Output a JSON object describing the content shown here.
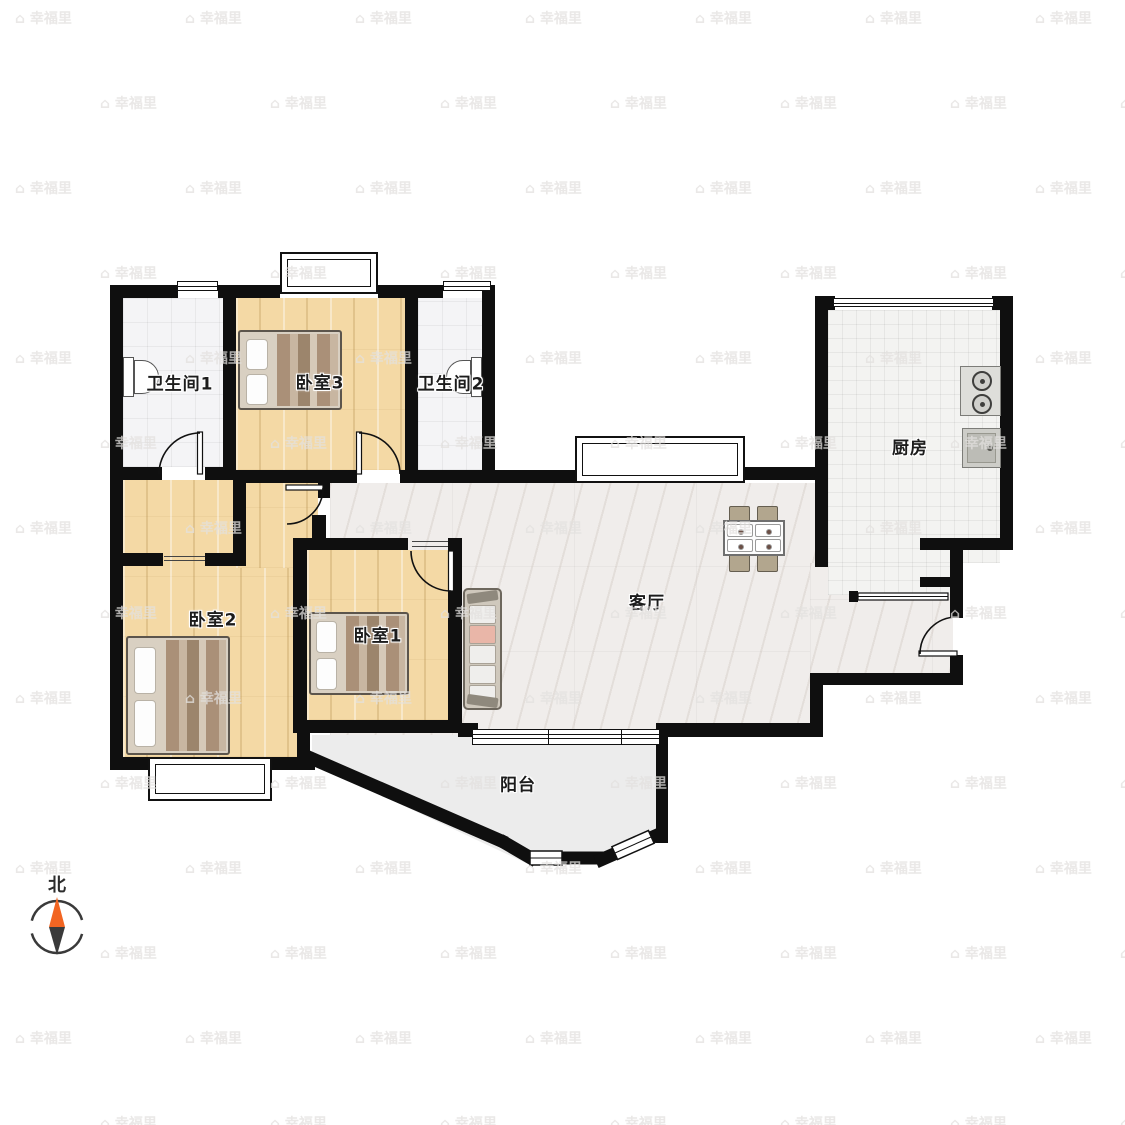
{
  "plan": {
    "type": "apartment-floor-plan",
    "rooms": {
      "bathroom1": {
        "label": "卫生间1"
      },
      "bedroom3": {
        "label": "卧室3"
      },
      "bathroom2": {
        "label": "卫生间2"
      },
      "kitchen": {
        "label": "厨房"
      },
      "bedroom2": {
        "label": "卧室2"
      },
      "bedroom1": {
        "label": "卧室1"
      },
      "living_room": {
        "label": "客厅"
      },
      "balcony": {
        "label": "阳台"
      }
    },
    "furniture_icons": [
      "bed-icon",
      "sofa-icon",
      "dining-table-icon",
      "chair-icon",
      "stove-icon",
      "sink-icon",
      "toilet-icon"
    ],
    "colors": {
      "wall": "#0f0f0f",
      "wood_floor": "#f4d9a5",
      "marble_floor": "#f0edeb",
      "tile_floor": "#f4f4f6",
      "balcony_floor": "#ececec",
      "compass_north": "#f26522"
    }
  },
  "compass": {
    "north_label": "北"
  },
  "watermark": {
    "text": "幸福里"
  }
}
